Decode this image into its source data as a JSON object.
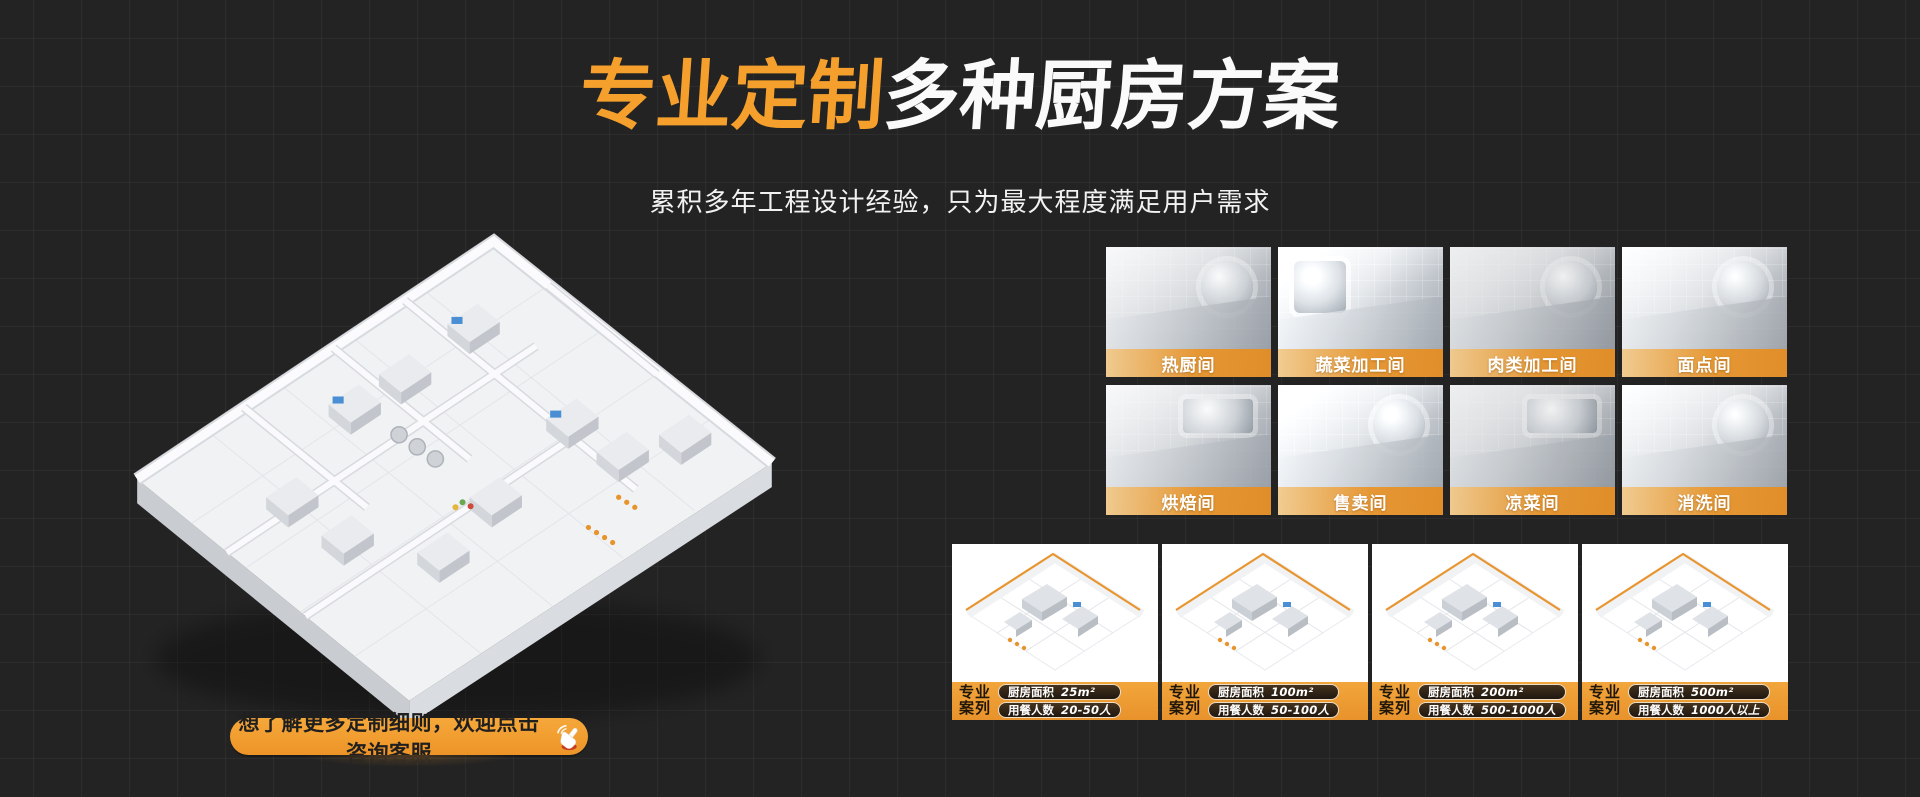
{
  "colors": {
    "background": "#232323",
    "accent_orange": "#F09B2F",
    "title_orange": "#F5A02C",
    "label_band_orange": "#EC9830",
    "pill_dark": "#241A10"
  },
  "hero": {
    "title_highlight": "专业定制",
    "title_rest": "多种厨房方案",
    "subtitle": "累积多年工程设计经验，只为最大程度满足用户需求"
  },
  "gallery": {
    "rooms": [
      {
        "label": "热厨间"
      },
      {
        "label": "蔬菜加工间"
      },
      {
        "label": "肉类加工间"
      },
      {
        "label": "面点间"
      },
      {
        "label": "烘焙间"
      },
      {
        "label": "售卖间"
      },
      {
        "label": "凉菜间"
      },
      {
        "label": "消洗间"
      }
    ]
  },
  "cases": {
    "badge_line1": "专业",
    "badge_line2": "案列",
    "area_label": "厨房面积",
    "diners_label": "用餐人数",
    "items": [
      {
        "area": "25m²",
        "diners": "20-50人"
      },
      {
        "area": "100m²",
        "diners": "50-100人"
      },
      {
        "area": "200m²",
        "diners": "500-1000人"
      },
      {
        "area": "500m²",
        "diners": "1000人以上"
      }
    ]
  },
  "cta": {
    "label": "想了解更多定制细则，欢迎点击咨询客服",
    "icon": "click-hand-icon"
  },
  "floorplan": {
    "icon": "isometric-kitchen-floorplan"
  }
}
